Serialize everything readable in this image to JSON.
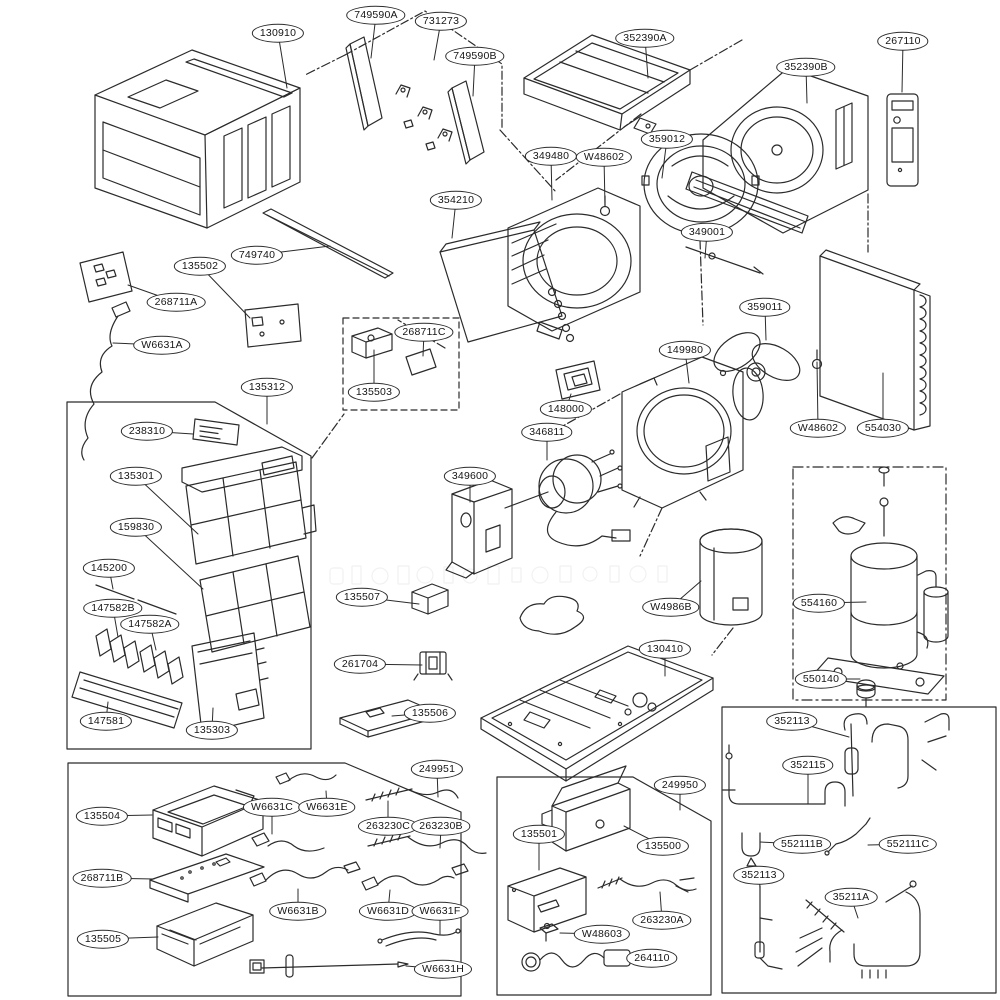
{
  "colors": {
    "line": "#2b2b2b",
    "dark_fill": "#161616",
    "background": "#ffffff",
    "label_border": "#2b2b2b"
  },
  "diagram": {
    "labels": [
      {
        "t": "130910",
        "x": 278,
        "y": 33,
        "tx": 287,
        "ty": 88
      },
      {
        "t": "749590A",
        "x": 376,
        "y": 15,
        "tx": 371,
        "ty": 58
      },
      {
        "t": "731273",
        "x": 441,
        "y": 21,
        "tx": 434,
        "ty": 60
      },
      {
        "t": "749590B",
        "x": 475,
        "y": 56,
        "tx": 473,
        "ty": 96
      },
      {
        "t": "352390A",
        "x": 645,
        "y": 38,
        "tx": 648,
        "ty": 78
      },
      {
        "t": "352390B",
        "x": 806,
        "y": 67,
        "tx": 807,
        "ty": 103
      },
      {
        "t": "267110",
        "x": 903,
        "y": 41,
        "tx": 902,
        "ty": 92
      },
      {
        "t": "349480",
        "x": 551,
        "y": 156,
        "tx": 552,
        "ty": 200
      },
      {
        "t": "W48602",
        "x": 604,
        "y": 157,
        "tx": 605,
        "ty": 206
      },
      {
        "t": "359012",
        "x": 667,
        "y": 139,
        "tx": 662,
        "ty": 178
      },
      {
        "t": "354210",
        "x": 456,
        "y": 200,
        "tx": 452,
        "ty": 238
      },
      {
        "t": "349001",
        "x": 707,
        "y": 232,
        "tx": 705,
        "ty": 258
      },
      {
        "t": "749740",
        "x": 257,
        "y": 255,
        "tx": 330,
        "ty": 246
      },
      {
        "t": "135502",
        "x": 200,
        "y": 266,
        "tx": 250,
        "ty": 318
      },
      {
        "t": "268711A",
        "x": 176,
        "y": 302,
        "tx": 128,
        "ty": 285
      },
      {
        "t": "W6631A",
        "x": 162,
        "y": 345,
        "tx": 113,
        "ty": 343
      },
      {
        "t": "135312",
        "x": 267,
        "y": 387,
        "tx": 267,
        "ty": 424
      },
      {
        "t": "238310",
        "x": 147,
        "y": 431,
        "tx": 193,
        "ty": 434
      },
      {
        "t": "268711C",
        "x": 424,
        "y": 332,
        "tx": 423,
        "ty": 356
      },
      {
        "t": "135503",
        "x": 374,
        "y": 392,
        "tx": 374,
        "ty": 350
      },
      {
        "t": "359011",
        "x": 765,
        "y": 307,
        "tx": 766,
        "ty": 340
      },
      {
        "t": "149980",
        "x": 685,
        "y": 350,
        "tx": 689,
        "ty": 383
      },
      {
        "t": "W48602",
        "x": 818,
        "y": 428,
        "tx": 817,
        "ty": 362
      },
      {
        "t": "554030",
        "x": 883,
        "y": 428,
        "tx": 883,
        "ty": 373
      },
      {
        "t": "148000",
        "x": 566,
        "y": 409,
        "tx": 571,
        "ty": 394
      },
      {
        "t": "346811",
        "x": 547,
        "y": 432,
        "tx": 547,
        "ty": 460
      },
      {
        "t": "349600",
        "x": 470,
        "y": 476,
        "tx": 470,
        "ty": 502
      },
      {
        "t": "135301",
        "x": 136,
        "y": 476,
        "tx": 198,
        "ty": 534
      },
      {
        "t": "159830",
        "x": 136,
        "y": 527,
        "tx": 203,
        "ty": 589
      },
      {
        "t": "145200",
        "x": 109,
        "y": 568,
        "tx": 113,
        "ty": 589
      },
      {
        "t": "147582B",
        "x": 113,
        "y": 608,
        "tx": 118,
        "ty": 637
      },
      {
        "t": "147582A",
        "x": 150,
        "y": 624,
        "tx": 156,
        "ty": 650
      },
      {
        "t": "147581",
        "x": 106,
        "y": 721,
        "tx": 108,
        "ty": 702
      },
      {
        "t": "135303",
        "x": 212,
        "y": 730,
        "tx": 213,
        "ty": 708
      },
      {
        "t": "135507",
        "x": 362,
        "y": 597,
        "tx": 419,
        "ty": 604
      },
      {
        "t": "261704",
        "x": 360,
        "y": 664,
        "tx": 422,
        "ty": 665
      },
      {
        "t": "135506",
        "x": 430,
        "y": 713,
        "tx": 392,
        "ty": 716
      },
      {
        "t": "W4986B",
        "x": 671,
        "y": 607,
        "tx": 701,
        "ty": 581
      },
      {
        "t": "130410",
        "x": 665,
        "y": 649,
        "tx": 665,
        "ty": 676
      },
      {
        "t": "554160",
        "x": 819,
        "y": 603,
        "tx": 866,
        "ty": 602
      },
      {
        "t": "550140",
        "x": 821,
        "y": 679,
        "tx": 860,
        "ty": 679
      },
      {
        "t": "249951",
        "x": 437,
        "y": 769,
        "tx": 438,
        "ty": 797
      },
      {
        "t": "135504",
        "x": 102,
        "y": 816,
        "tx": 152,
        "ty": 815
      },
      {
        "t": "W6631C",
        "x": 272,
        "y": 807,
        "tx": 272,
        "ty": 834
      },
      {
        "t": "W6631E",
        "x": 327,
        "y": 807,
        "tx": 326,
        "ty": 791
      },
      {
        "t": "263230C",
        "x": 388,
        "y": 826,
        "tx": 388,
        "ty": 801
      },
      {
        "t": "263230B",
        "x": 441,
        "y": 826,
        "tx": 440,
        "ty": 848
      },
      {
        "t": "268711B",
        "x": 102,
        "y": 878,
        "tx": 154,
        "ty": 879
      },
      {
        "t": "W6631B",
        "x": 298,
        "y": 911,
        "tx": 298,
        "ty": 889
      },
      {
        "t": "W6631D",
        "x": 388,
        "y": 911,
        "tx": 390,
        "ty": 890
      },
      {
        "t": "W6631F",
        "x": 440,
        "y": 911,
        "tx": 440,
        "ty": 934
      },
      {
        "t": "135505",
        "x": 103,
        "y": 939,
        "tx": 158,
        "ty": 937
      },
      {
        "t": "W6631H",
        "x": 443,
        "y": 969,
        "tx": 406,
        "ty": 966
      },
      {
        "t": "249950",
        "x": 680,
        "y": 785,
        "tx": 680,
        "ty": 810
      },
      {
        "t": "135501",
        "x": 539,
        "y": 834,
        "tx": 539,
        "ty": 870
      },
      {
        "t": "135500",
        "x": 663,
        "y": 846,
        "tx": 624,
        "ty": 826
      },
      {
        "t": "263230A",
        "x": 662,
        "y": 920,
        "tx": 660,
        "ty": 892
      },
      {
        "t": "W48603",
        "x": 602,
        "y": 934,
        "tx": 560,
        "ty": 933
      },
      {
        "t": "264110",
        "x": 652,
        "y": 958,
        "tx": 628,
        "ty": 958
      },
      {
        "t": "352113",
        "x": 792,
        "y": 721,
        "tx": 849,
        "ty": 737
      },
      {
        "t": "352115",
        "x": 808,
        "y": 765,
        "tx": 808,
        "ty": 804
      },
      {
        "t": "552111B",
        "x": 802,
        "y": 844,
        "tx": 760,
        "ty": 842
      },
      {
        "t": "552111C",
        "x": 908,
        "y": 844,
        "tx": 868,
        "ty": 845
      },
      {
        "t": "352113",
        "x": 759,
        "y": 875,
        "tx": 760,
        "ty": 888
      },
      {
        "t": "35211A",
        "x": 851,
        "y": 897,
        "tx": 858,
        "ty": 918
      }
    ]
  }
}
